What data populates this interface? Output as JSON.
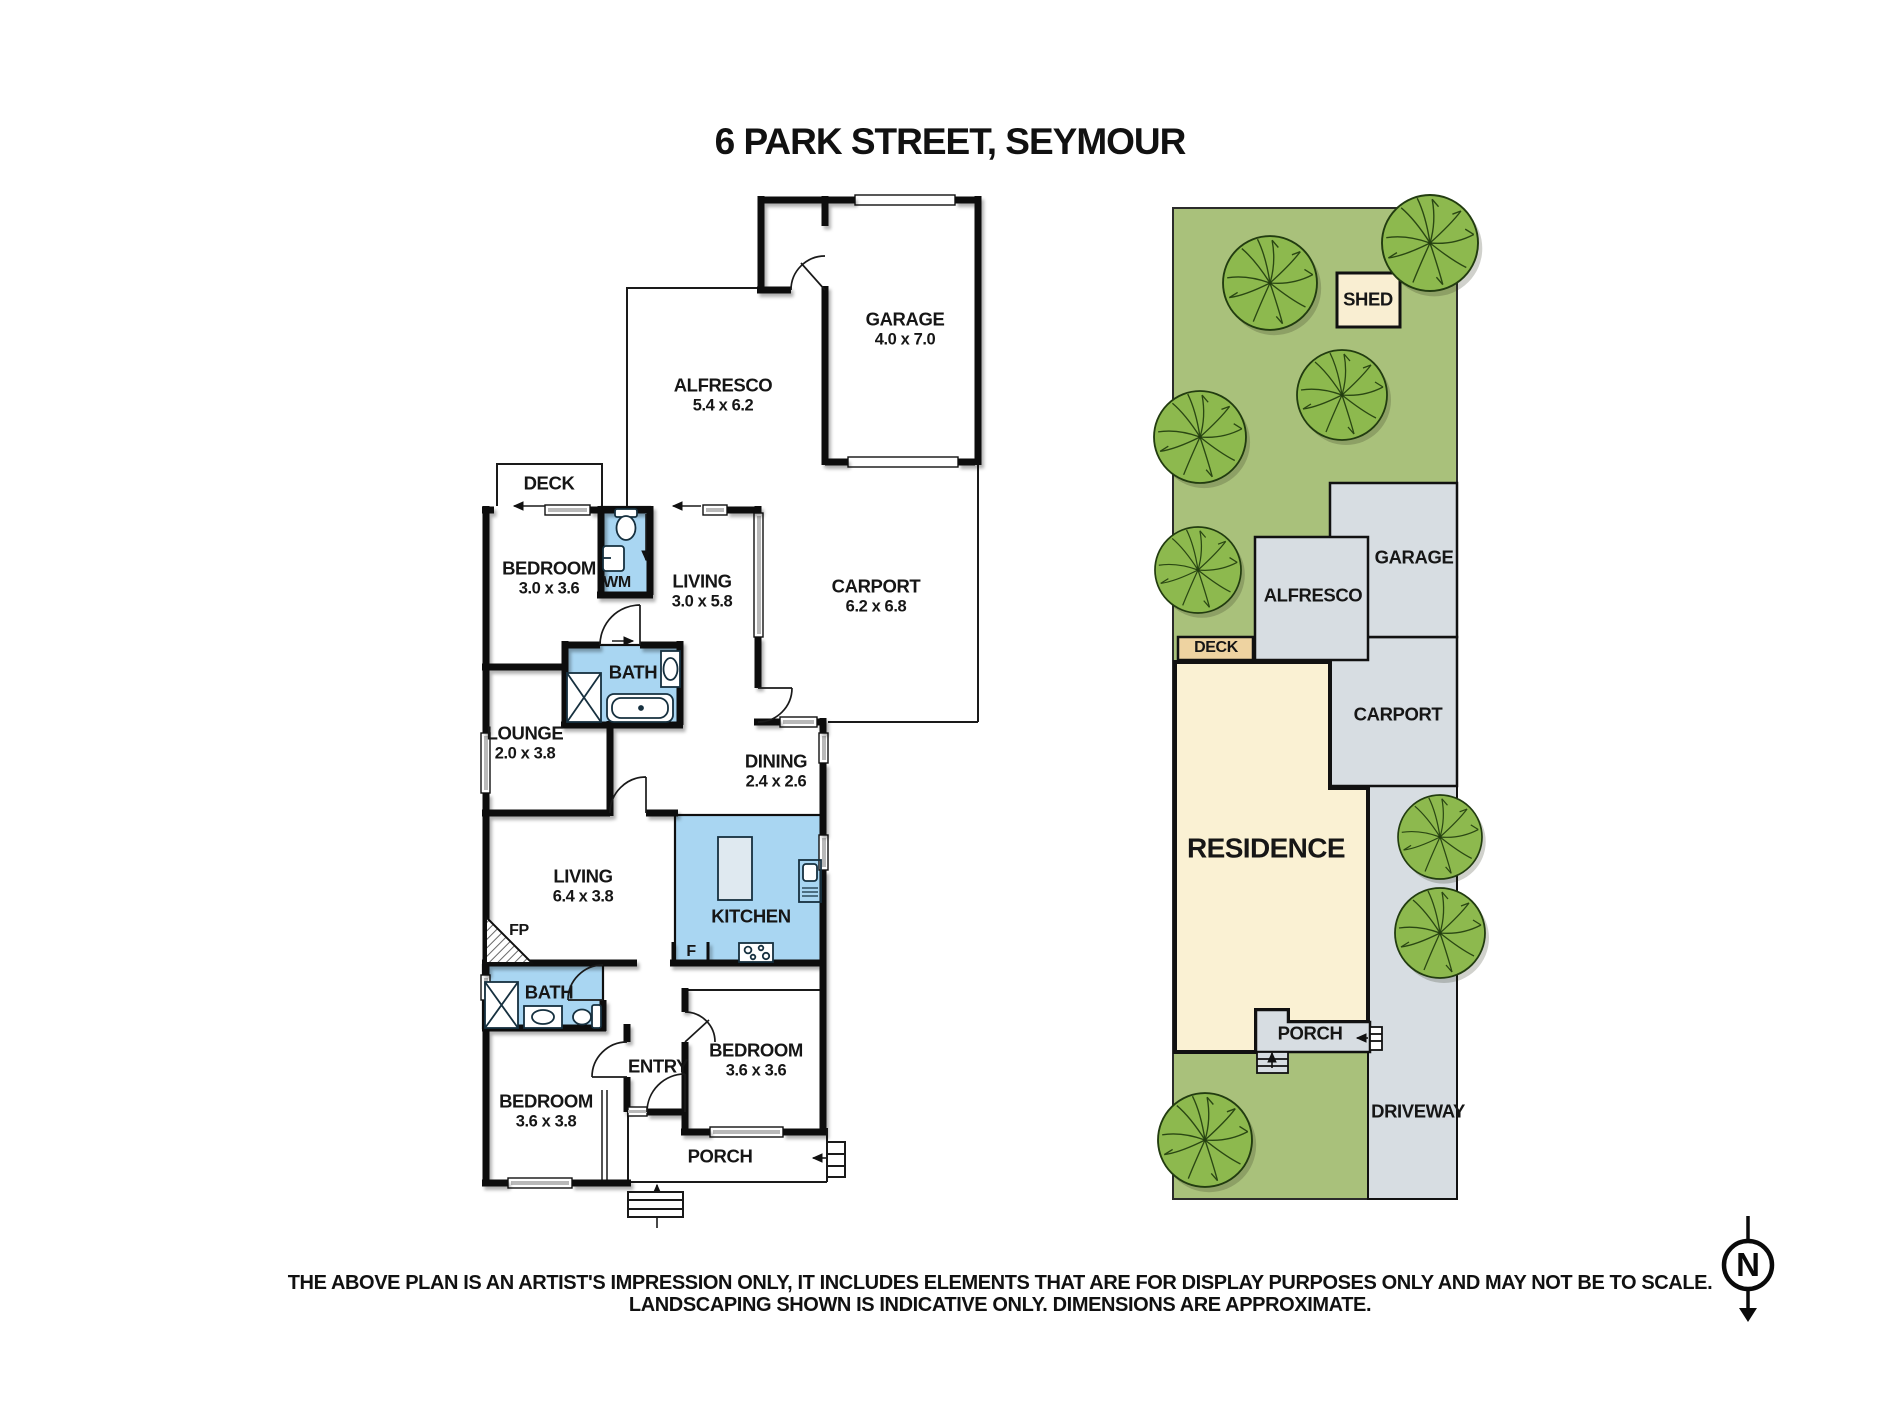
{
  "title": "6 PARK STREET, SEYMOUR",
  "floor_plan": {
    "rooms": [
      {
        "name": "GARAGE",
        "dims": "4.0 x 7.0",
        "x": 905,
        "y": 329
      },
      {
        "name": "ALFRESCO",
        "dims": "5.4 x 6.2",
        "x": 723,
        "y": 395
      },
      {
        "name": "DECK",
        "dims": "",
        "x": 549,
        "y": 484
      },
      {
        "name": "BEDROOM",
        "dims": "3.0 x 3.6",
        "x": 549,
        "y": 578
      },
      {
        "name": "WM",
        "dims": "",
        "x": 617,
        "y": 583,
        "size": "sm"
      },
      {
        "name": "LIVING",
        "dims": "3.0 x 5.8",
        "x": 702,
        "y": 591
      },
      {
        "name": "CARPORT",
        "dims": "6.2 x 6.8",
        "x": 876,
        "y": 596
      },
      {
        "name": "BATH",
        "dims": "",
        "x": 633,
        "y": 673
      },
      {
        "name": "LOUNGE",
        "dims": "2.0 x 3.8",
        "x": 525,
        "y": 743
      },
      {
        "name": "DINING",
        "dims": "2.4 x 2.6",
        "x": 776,
        "y": 771
      },
      {
        "name": "LIVING",
        "dims": "6.4 x 3.8",
        "x": 583,
        "y": 886
      },
      {
        "name": "KITCHEN",
        "dims": "",
        "x": 751,
        "y": 917
      },
      {
        "name": "FP",
        "dims": "",
        "x": 519,
        "y": 931,
        "size": "sm"
      },
      {
        "name": "F",
        "dims": "",
        "x": 691,
        "y": 952,
        "size": "sm"
      },
      {
        "name": "BATH",
        "dims": "",
        "x": 549,
        "y": 993
      },
      {
        "name": "BEDROOM",
        "dims": "3.6 x 3.6",
        "x": 756,
        "y": 1060
      },
      {
        "name": "ENTRY",
        "dims": "",
        "x": 658,
        "y": 1067
      },
      {
        "name": "BEDROOM",
        "dims": "3.6 x 3.8",
        "x": 546,
        "y": 1111
      },
      {
        "name": "PORCH",
        "dims": "",
        "x": 720,
        "y": 1157
      }
    ]
  },
  "site_plan": {
    "labels": [
      {
        "name": "SHED",
        "x": 1368,
        "y": 300
      },
      {
        "name": "GARAGE",
        "x": 1414,
        "y": 558
      },
      {
        "name": "ALFRESCO",
        "x": 1313,
        "y": 596
      },
      {
        "name": "DECK",
        "x": 1216,
        "y": 648,
        "size": "sm"
      },
      {
        "name": "CARPORT",
        "x": 1398,
        "y": 715
      },
      {
        "name": "RESIDENCE",
        "x": 1266,
        "y": 848,
        "size": "lg"
      },
      {
        "name": "PORCH",
        "x": 1310,
        "y": 1034
      },
      {
        "name": "DRIVEWAY",
        "x": 1418,
        "y": 1112
      }
    ]
  },
  "disclaimer": {
    "line1": "THE ABOVE PLAN IS AN ARTIST'S IMPRESSION ONLY, IT INCLUDES ELEMENTS THAT ARE FOR DISPLAY PURPOSES ONLY AND MAY NOT BE TO SCALE.",
    "line2": "LANDSCAPING SHOWN IS INDICATIVE ONLY. DIMENSIONS ARE APPROXIMATE."
  },
  "compass": {
    "letter": "N"
  },
  "colors": {
    "wall_black": "#0f0f0f",
    "wet_area_blue": "#a9d6f2",
    "lawn_green": "#a9c17b",
    "tree_green": "#8db94e",
    "hardstand_grey": "#d7dde2",
    "residence_cream": "#faf1d3",
    "deck_tan": "#eed3a1",
    "shed_beige": "#f9eed2",
    "window_grey": "#b9b9b9"
  }
}
